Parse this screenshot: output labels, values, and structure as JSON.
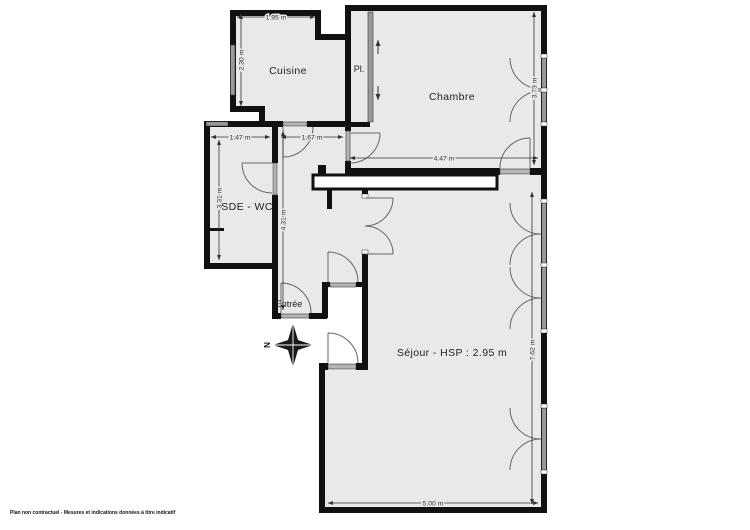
{
  "plan": {
    "rooms": [
      {
        "id": "cuisine",
        "label": "Cuisine"
      },
      {
        "id": "placard",
        "label": "Pl."
      },
      {
        "id": "chambre",
        "label": "Chambre"
      },
      {
        "id": "sde_wc",
        "label": "SDE - WC"
      },
      {
        "id": "entree",
        "label": "Entrée"
      },
      {
        "id": "sejour",
        "label": "Séjour - HSP : 2.95 m"
      }
    ],
    "dimensions": {
      "cuisine_width": "1.95 m",
      "cuisine_height": "2.30 m",
      "sde_width": "1.47 m",
      "hall_width": "1.67 m",
      "sde_height": "3.31 m",
      "corridor_height": "4.31 m",
      "chambre_width": "4.47 m",
      "chambre_height": "3.73 m",
      "sejour_height": "7.62 m",
      "sejour_width": "5.00 m"
    },
    "compass": {
      "north_label": "N"
    },
    "footer": {
      "disclaimer": "Plan non contractuel - Mesures et indications données à titre indicatif"
    },
    "colors": {
      "interior": "#e9e9e9",
      "wall": "#111111",
      "window": "#9a9a9a",
      "dimension": "#333333",
      "background": "#ffffff"
    }
  }
}
